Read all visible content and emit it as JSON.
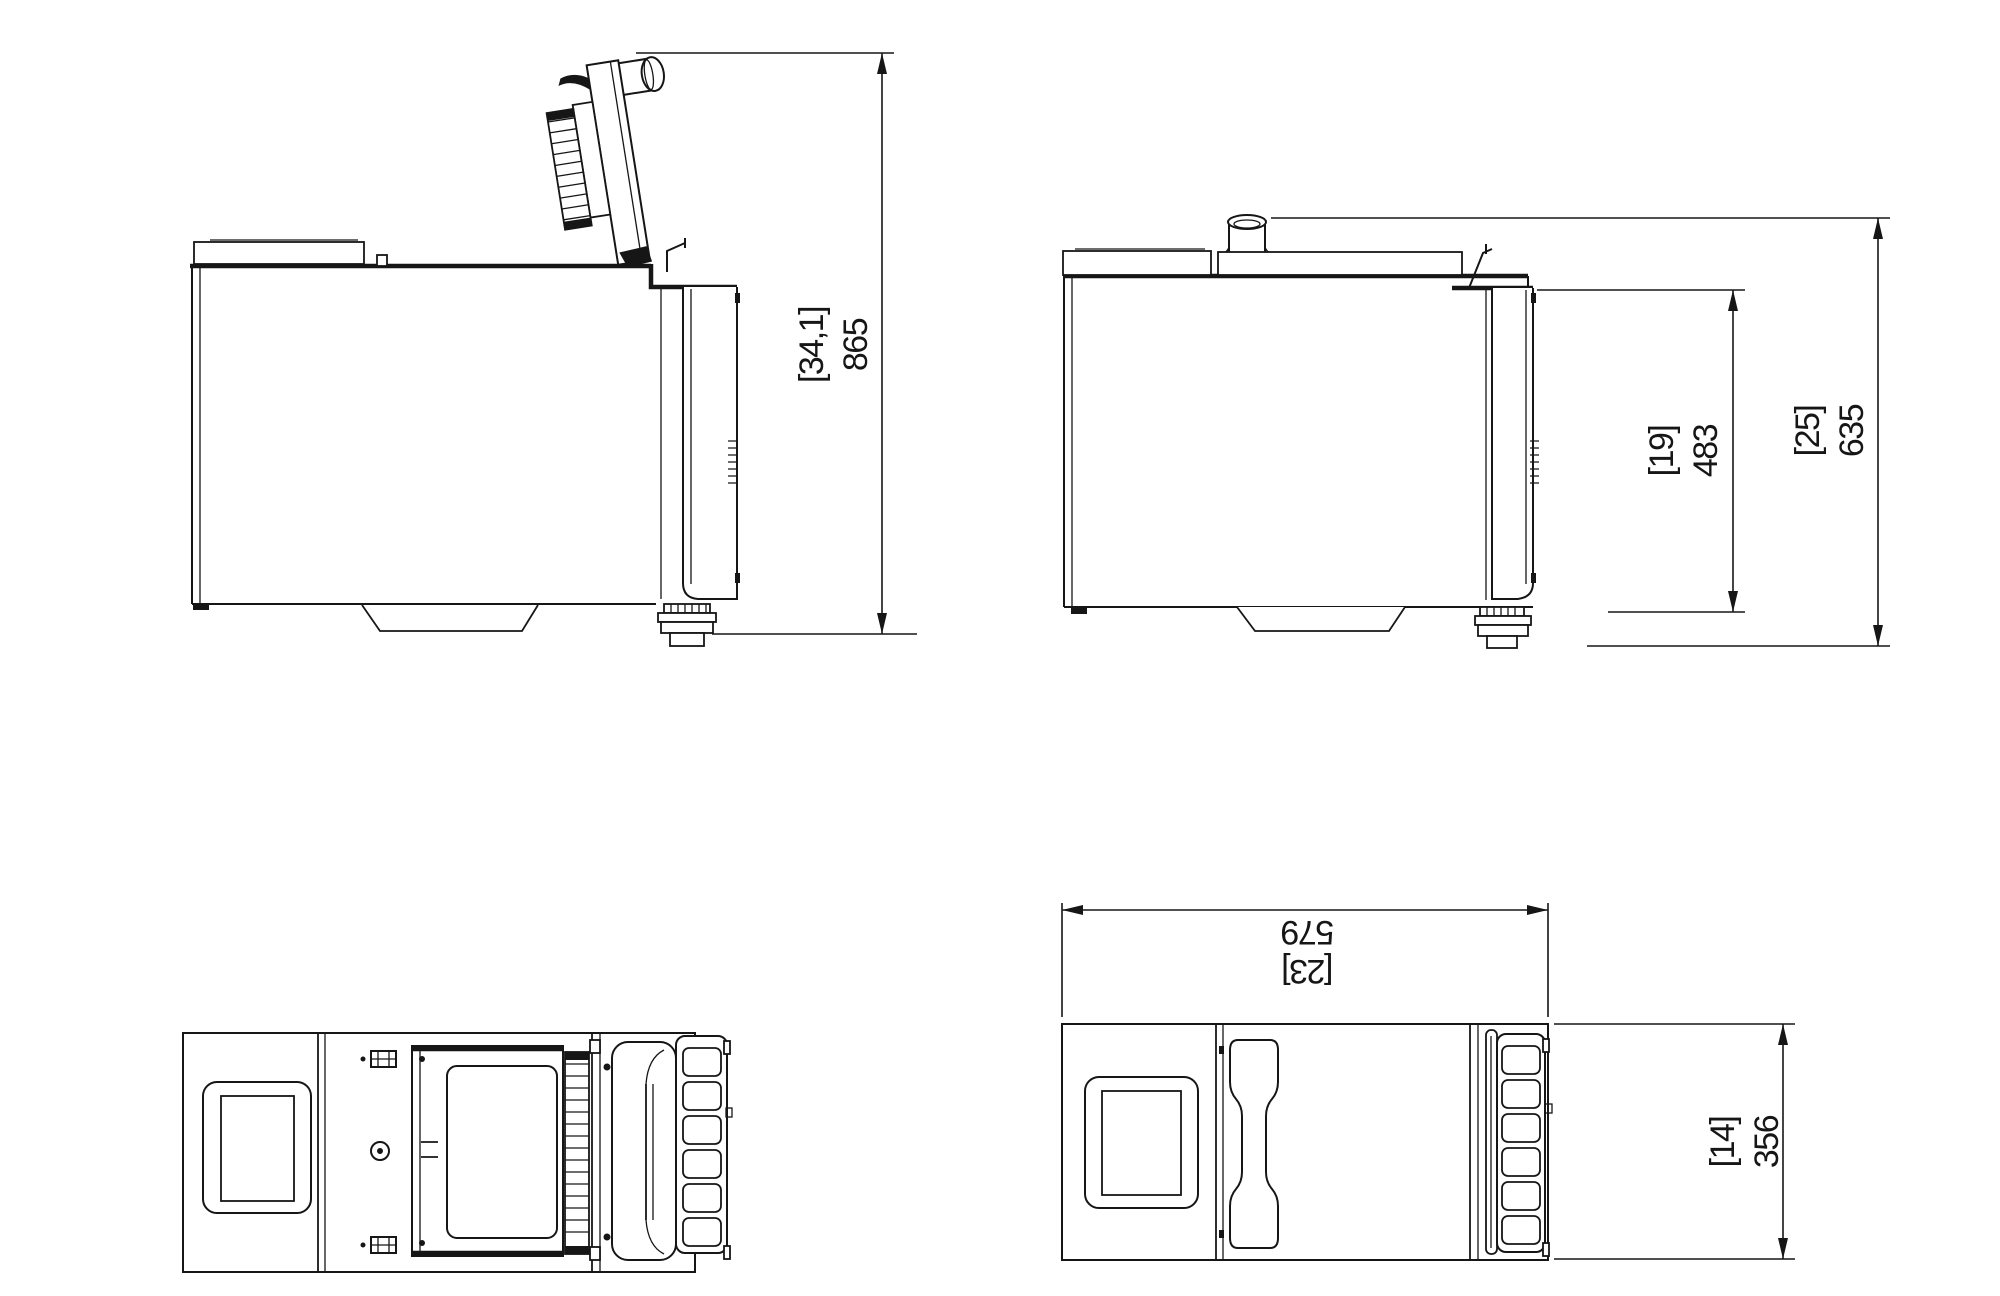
{
  "drawing": {
    "background_color": "#ffffff",
    "line_color": "#161616",
    "dimensions": {
      "height_total": {
        "inch_label": "[34,1]",
        "mm_label": "865"
      },
      "door_height": {
        "inch_label": "[19]",
        "mm_label": "483"
      },
      "body_height": {
        "inch_label": "[25]",
        "mm_label": "635"
      },
      "depth": {
        "inch_label": "[23]",
        "mm_label": "579"
      },
      "width": {
        "inch_label": "[14]",
        "mm_label": "356"
      }
    }
  }
}
